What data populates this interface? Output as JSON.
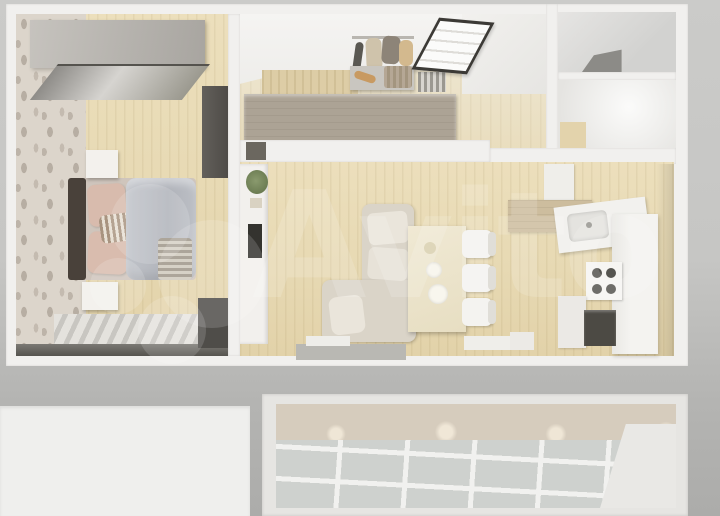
{
  "watermark": {
    "text": "Avito"
  },
  "scene": {
    "kind": "3d-floorplan-top-view-render",
    "regions": [
      "bedroom",
      "hallway",
      "bathroom",
      "toilet",
      "living-room",
      "kitchen",
      "balcony",
      "white-panel"
    ]
  },
  "palette": {
    "background_gray": "#c6c6c4",
    "wall_white": "#f1f0ee",
    "wood_floor": "#e7d9b3",
    "wallpaper_beige": "#dcd5cb",
    "hall_wardrobe_taupe": "#aca395",
    "sofa_beige": "#dad4c8",
    "duvet_gray": "#b6b9bf",
    "pillow_pink": "#d8bbad",
    "table_cream": "#ebe3ca",
    "dark_appliance": "#4c4a44",
    "balcony_tile_gray": "#ced1ce",
    "balcony_wall_beige": "#d6ccbd"
  }
}
